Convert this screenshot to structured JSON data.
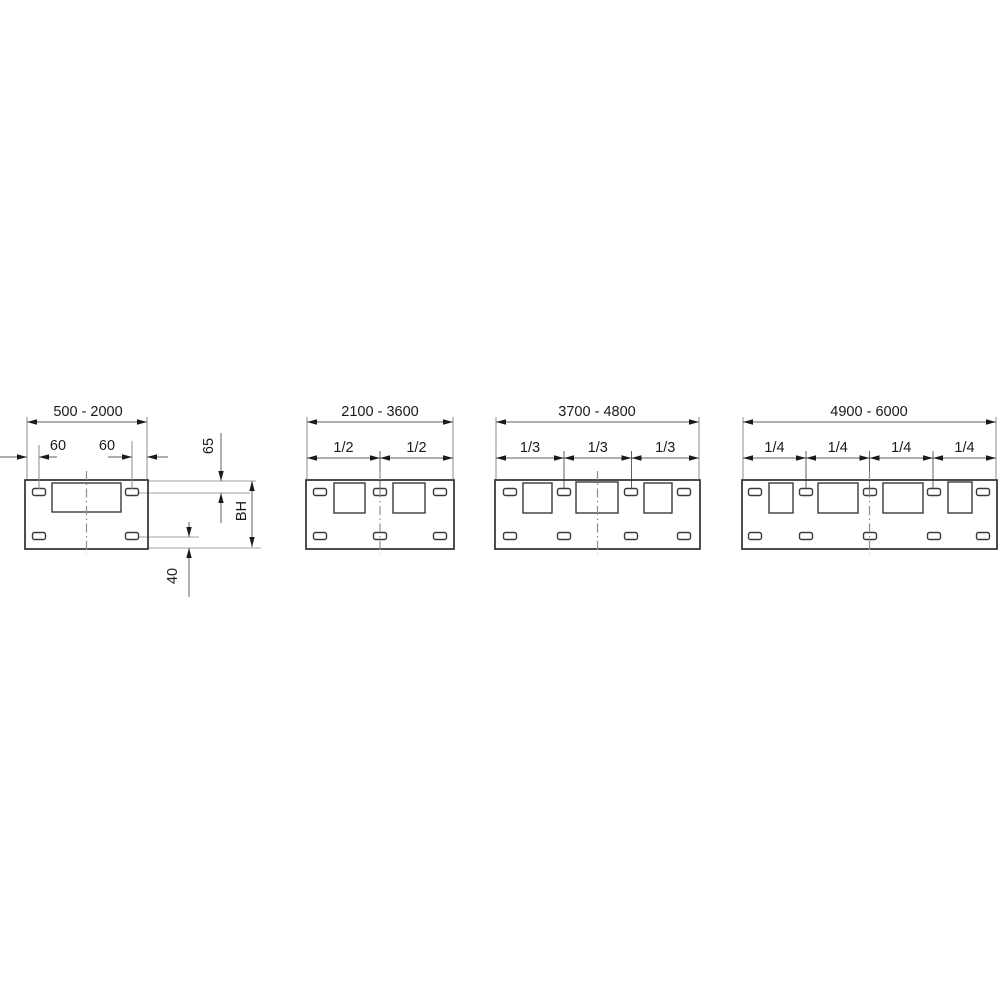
{
  "diagram": {
    "type": "technical-drawing",
    "description": "Four panel width variants with mounting-slot dimensioning",
    "figure": {
      "width": 1000,
      "height": 1000,
      "bg": "#ffffff"
    },
    "style": {
      "outline_color": "#2e2e2e",
      "inner_color": "#3a3a3a",
      "dim_line_color": "#5f5f5f",
      "ext_line_color": "#8c8c8c",
      "ref_line_color": "#a3a3a3",
      "center_line_color": "#8f8f8f",
      "arrow_color": "#1a1a1a",
      "text_color": "#1a1a1a",
      "font_size": 14.5
    },
    "layout": {
      "panel_top": 480,
      "panel_bottom": 549,
      "top_dim_y": 422,
      "split_dim_y": 458,
      "top_label_baseline_y": 416,
      "split_label_baseline_y": 452,
      "ext_top_y": 417,
      "ext_bottom_y": 479,
      "division_ext_y1": 451,
      "division_ext_y2": 489,
      "slot_w": 13,
      "slot_h": 7,
      "slot_rx": 2,
      "slot_top_cy": 492,
      "slot_bottom_cy": 536,
      "centerline_y1": 471,
      "centerline_y2": 554,
      "arrow_len": 10,
      "arrow_half": 2.7
    },
    "panels": [
      {
        "id": "panel-500-2000",
        "range_label": "500 - 2000",
        "body": {
          "x": 25,
          "y": 480,
          "w": 123,
          "h": 69
        },
        "windows": [
          [
            52,
            483,
            69,
            29
          ]
        ],
        "slot_cx": [
          39,
          132
        ],
        "center_x": 86.5,
        "top_dim": {
          "x1": 27,
          "x2": 147,
          "label_cx": 88
        }
      },
      {
        "id": "panel-2100-3600",
        "range_label": "2100 - 3600",
        "body": {
          "x": 306,
          "y": 480,
          "w": 148,
          "h": 69
        },
        "windows": [
          [
            334,
            483,
            31,
            30
          ],
          [
            393,
            483,
            32,
            30
          ]
        ],
        "slot_cx": [
          320,
          380,
          440
        ],
        "center_x": 380,
        "top_dim": {
          "x1": 307,
          "x2": 453,
          "label_cx": 380
        },
        "split_dim": {
          "divisions": [
            380
          ],
          "labels": [
            "1/2",
            "1/2"
          ]
        }
      },
      {
        "id": "panel-3700-4800",
        "range_label": "3700 - 4800",
        "body": {
          "x": 495,
          "y": 480,
          "w": 205,
          "h": 69
        },
        "windows": [
          [
            523,
            483,
            29,
            30
          ],
          [
            576,
            482,
            42,
            31
          ],
          [
            644,
            483,
            28,
            30
          ]
        ],
        "slot_cx": [
          510,
          564,
          631,
          684
        ],
        "center_x": 597.5,
        "top_dim": {
          "x1": 496,
          "x2": 699,
          "label_cx": 597
        },
        "split_dim": {
          "divisions": [
            564,
            631.5
          ],
          "labels": [
            "1/3",
            "1/3",
            "1/3"
          ]
        }
      },
      {
        "id": "panel-4900-6000",
        "range_label": "4900 - 6000",
        "body": {
          "x": 742,
          "y": 480,
          "w": 255,
          "h": 69
        },
        "windows": [
          [
            769,
            483,
            24,
            30
          ],
          [
            818,
            483,
            40,
            30
          ],
          [
            883,
            483,
            40,
            30
          ],
          [
            948,
            482,
            24,
            31
          ]
        ],
        "slot_cx": [
          755,
          806,
          870,
          934,
          983
        ],
        "center_x": 869.5,
        "top_dim": {
          "x1": 743,
          "x2": 996,
          "label_cx": 869
        },
        "split_dim": {
          "divisions": [
            806,
            869.5,
            933
          ],
          "labels": [
            "1/4",
            "1/4",
            "1/4",
            "1/4"
          ]
        }
      }
    ],
    "detail": {
      "ref_lines": [
        {
          "y": 481,
          "x1": 148,
          "x2": 256
        },
        {
          "y": 493,
          "x1": 139,
          "x2": 250
        },
        {
          "y": 537,
          "x1": 139,
          "x2": 199
        },
        {
          "y": 548,
          "x1": 149,
          "x2": 261
        }
      ],
      "dims": {
        "left_slot_offset": {
          "label": "60",
          "line_y": 457,
          "edge_x": 27,
          "lead_from_x": 0,
          "slot_x": 39,
          "tail_to_x": 57,
          "label_cx": 58,
          "label_baseline_y": 450,
          "ext_x": 39,
          "ext_y1": 445,
          "ext_y2": 489
        },
        "right_slot_offset": {
          "label": "60",
          "line_y": 457,
          "slot_x": 132,
          "tail_from_x": 108,
          "edge_x": 147,
          "tail_to_x": 168,
          "label_cx": 107,
          "label_baseline_y": 450,
          "ext_x": 132,
          "ext_y1": 441,
          "ext_y2": 489
        },
        "top_slot_inset": {
          "label": "65",
          "line_x": 221,
          "tip1_y": 481,
          "tail1_y": 433,
          "tip2_y": 493,
          "tail2_y": 523,
          "label_cx": 208,
          "label_cy": 446
        },
        "body_height": {
          "label": "BH",
          "line_x": 252,
          "y1": 481,
          "y2": 547,
          "label_cx": 241,
          "label_cy": 511
        },
        "bottom_slot_inset": {
          "label": "40",
          "line_x": 189,
          "tip1_y": 537,
          "tail1_y": 522,
          "tip2_y": 548,
          "tail2_y": 597,
          "label_cx": 172,
          "label_cy": 576
        }
      }
    }
  }
}
